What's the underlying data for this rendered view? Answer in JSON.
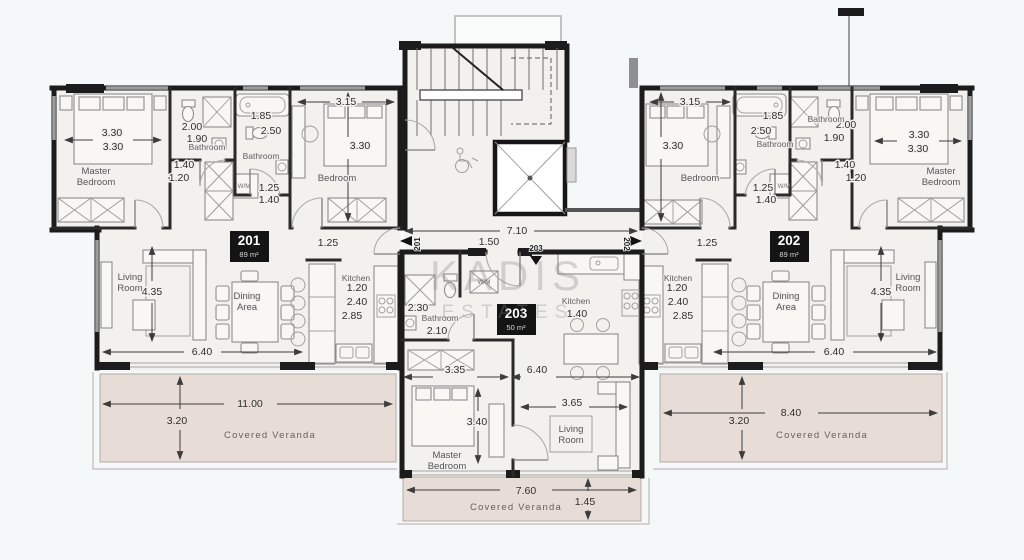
{
  "watermark": {
    "line1": "KADIS",
    "line2": "ESTATES"
  },
  "units": [
    {
      "id": "201",
      "area": "89 m²"
    },
    {
      "id": "202",
      "area": "89 m²"
    },
    {
      "id": "203",
      "area": "50 m²"
    }
  ],
  "colors": {
    "wall": "#1c1c1c",
    "floor": "#f2f1ee",
    "veranda": "#e8dcd7",
    "badge_bg": "#141414",
    "background": "#f4f8f8"
  },
  "labels": [
    {
      "t": "3.30",
      "x": 112,
      "y": 136,
      "c": "d"
    },
    {
      "t": "3.30",
      "x": 113,
      "y": 150,
      "c": "d"
    },
    {
      "t": "2.00",
      "x": 192,
      "y": 130,
      "c": "d"
    },
    {
      "t": "1.90",
      "x": 197,
      "y": 142,
      "c": "d"
    },
    {
      "t": "1.85",
      "x": 261,
      "y": 119,
      "c": "d"
    },
    {
      "t": "2.50",
      "x": 271,
      "y": 134,
      "c": "d"
    },
    {
      "t": "1.40",
      "x": 184,
      "y": 168,
      "c": "d"
    },
    {
      "t": "1.20",
      "x": 179,
      "y": 181,
      "c": "d"
    },
    {
      "t": "1.25",
      "x": 269,
      "y": 191,
      "c": "d"
    },
    {
      "t": "1.40",
      "x": 269,
      "y": 203,
      "c": "d"
    },
    {
      "t": "3.15",
      "x": 346,
      "y": 105,
      "c": "d"
    },
    {
      "t": "3.30",
      "x": 360,
      "y": 149,
      "c": "d"
    },
    {
      "t": "1.25",
      "x": 328,
      "y": 246,
      "c": "d"
    },
    {
      "t": "1.20",
      "x": 357,
      "y": 291,
      "c": "d"
    },
    {
      "t": "2.40",
      "x": 357,
      "y": 305,
      "c": "d"
    },
    {
      "t": "2.85",
      "x": 352,
      "y": 319,
      "c": "d"
    },
    {
      "t": "4.35",
      "x": 152,
      "y": 295,
      "c": "d"
    },
    {
      "t": "6.40",
      "x": 202,
      "y": 355,
      "c": "d"
    },
    {
      "t": "11.00",
      "x": 250,
      "y": 407,
      "c": "dv"
    },
    {
      "t": "3.20",
      "x": 177,
      "y": 424,
      "c": "dv"
    },
    {
      "t": "3.15",
      "x": 690,
      "y": 105,
      "c": "d"
    },
    {
      "t": "3.30",
      "x": 673,
      "y": 149,
      "c": "d"
    },
    {
      "t": "1.85",
      "x": 773,
      "y": 119,
      "c": "d"
    },
    {
      "t": "2.50",
      "x": 761,
      "y": 134,
      "c": "d"
    },
    {
      "t": "2.00",
      "x": 846,
      "y": 128,
      "c": "d"
    },
    {
      "t": "1.90",
      "x": 834,
      "y": 141,
      "c": "d"
    },
    {
      "t": "1.40",
      "x": 845,
      "y": 168,
      "c": "d"
    },
    {
      "t": "1.20",
      "x": 856,
      "y": 181,
      "c": "d"
    },
    {
      "t": "1.25",
      "x": 763,
      "y": 191,
      "c": "d"
    },
    {
      "t": "1.40",
      "x": 766,
      "y": 203,
      "c": "d"
    },
    {
      "t": "3.30",
      "x": 919,
      "y": 138,
      "c": "d"
    },
    {
      "t": "3.30",
      "x": 918,
      "y": 152,
      "c": "d"
    },
    {
      "t": "1.25",
      "x": 707,
      "y": 246,
      "c": "d"
    },
    {
      "t": "1.20",
      "x": 677,
      "y": 291,
      "c": "d"
    },
    {
      "t": "2.40",
      "x": 678,
      "y": 305,
      "c": "d"
    },
    {
      "t": "2.85",
      "x": 683,
      "y": 319,
      "c": "d"
    },
    {
      "t": "4.35",
      "x": 881,
      "y": 295,
      "c": "d"
    },
    {
      "t": "6.40",
      "x": 834,
      "y": 355,
      "c": "d"
    },
    {
      "t": "8.40",
      "x": 791,
      "y": 416,
      "c": "dv"
    },
    {
      "t": "3.20",
      "x": 739,
      "y": 424,
      "c": "dv"
    },
    {
      "t": "2.30",
      "x": 418,
      "y": 311,
      "c": "d"
    },
    {
      "t": "2.10",
      "x": 437,
      "y": 334,
      "c": "d"
    },
    {
      "t": "1.40",
      "x": 577,
      "y": 317,
      "c": "d"
    },
    {
      "t": "3.35",
      "x": 455,
      "y": 373,
      "c": "d"
    },
    {
      "t": "6.40",
      "x": 537,
      "y": 373,
      "c": "d"
    },
    {
      "t": "3.40",
      "x": 477,
      "y": 425,
      "c": "d"
    },
    {
      "t": "3.65",
      "x": 572,
      "y": 406,
      "c": "d"
    },
    {
      "t": "7.60",
      "x": 526,
      "y": 494,
      "c": "dv"
    },
    {
      "t": "1.45",
      "x": 585,
      "y": 505,
      "c": "dv"
    },
    {
      "t": "7.10",
      "x": 517,
      "y": 234,
      "c": "d"
    },
    {
      "t": "1.50",
      "x": 489,
      "y": 245,
      "c": "d"
    },
    {
      "t": "Master\nBedroom",
      "x": 96,
      "y": 174,
      "c": "r"
    },
    {
      "t": "Bathroom",
      "x": 207,
      "y": 150,
      "c": "rs"
    },
    {
      "t": "Bathroom",
      "x": 261,
      "y": 159,
      "c": "rs"
    },
    {
      "t": "Bedroom",
      "x": 337,
      "y": 181,
      "c": "r"
    },
    {
      "t": "Living\nRoom",
      "x": 130,
      "y": 280,
      "c": "r"
    },
    {
      "t": "Dining\nArea",
      "x": 247,
      "y": 299,
      "c": "r"
    },
    {
      "t": "Kitchen",
      "x": 356,
      "y": 281,
      "c": "rs"
    },
    {
      "t": "W/M",
      "x": 244,
      "y": 188,
      "c": "wm"
    },
    {
      "t": "Covered Veranda",
      "x": 270,
      "y": 438,
      "c": "v"
    },
    {
      "t": "Bedroom",
      "x": 700,
      "y": 181,
      "c": "r"
    },
    {
      "t": "Bathroom",
      "x": 775,
      "y": 147,
      "c": "rs"
    },
    {
      "t": "Bathroom",
      "x": 826,
      "y": 122,
      "c": "rs"
    },
    {
      "t": "Master\nBedroom",
      "x": 941,
      "y": 174,
      "c": "r"
    },
    {
      "t": "Living\nRoom",
      "x": 908,
      "y": 280,
      "c": "r"
    },
    {
      "t": "Dining\nArea",
      "x": 786,
      "y": 299,
      "c": "r"
    },
    {
      "t": "Kitchen",
      "x": 678,
      "y": 281,
      "c": "rs"
    },
    {
      "t": "W/M",
      "x": 784,
      "y": 188,
      "c": "wm"
    },
    {
      "t": "Covered Veranda",
      "x": 822,
      "y": 438,
      "c": "v"
    },
    {
      "t": "Bathroom",
      "x": 440,
      "y": 321,
      "c": "rs"
    },
    {
      "t": "Kitchen",
      "x": 576,
      "y": 304,
      "c": "rs"
    },
    {
      "t": "W/M",
      "x": 484,
      "y": 284,
      "c": "wm"
    },
    {
      "t": "Master\nBedroom",
      "x": 447,
      "y": 458,
      "c": "r"
    },
    {
      "t": "Living\nRoom",
      "x": 571,
      "y": 432,
      "c": "r"
    },
    {
      "t": "Covered Veranda",
      "x": 516,
      "y": 510,
      "c": "v"
    },
    {
      "t": "201",
      "x": 420,
      "y": 244,
      "c": "e",
      "r": -90,
      "n": "entry-label-201"
    },
    {
      "t": "202",
      "x": 624,
      "y": 244,
      "c": "e",
      "r": 90,
      "n": "entry-label-202"
    },
    {
      "t": "203",
      "x": 536,
      "y": 251,
      "c": "e",
      "n": "entry-label-203"
    },
    {
      "t": "KADIS",
      "x": 508,
      "y": 290,
      "c": "w1",
      "n": "watermark-line1"
    },
    {
      "t": "ESTATES",
      "x": 508,
      "y": 318,
      "c": "w2",
      "n": "watermark-line2"
    }
  ]
}
